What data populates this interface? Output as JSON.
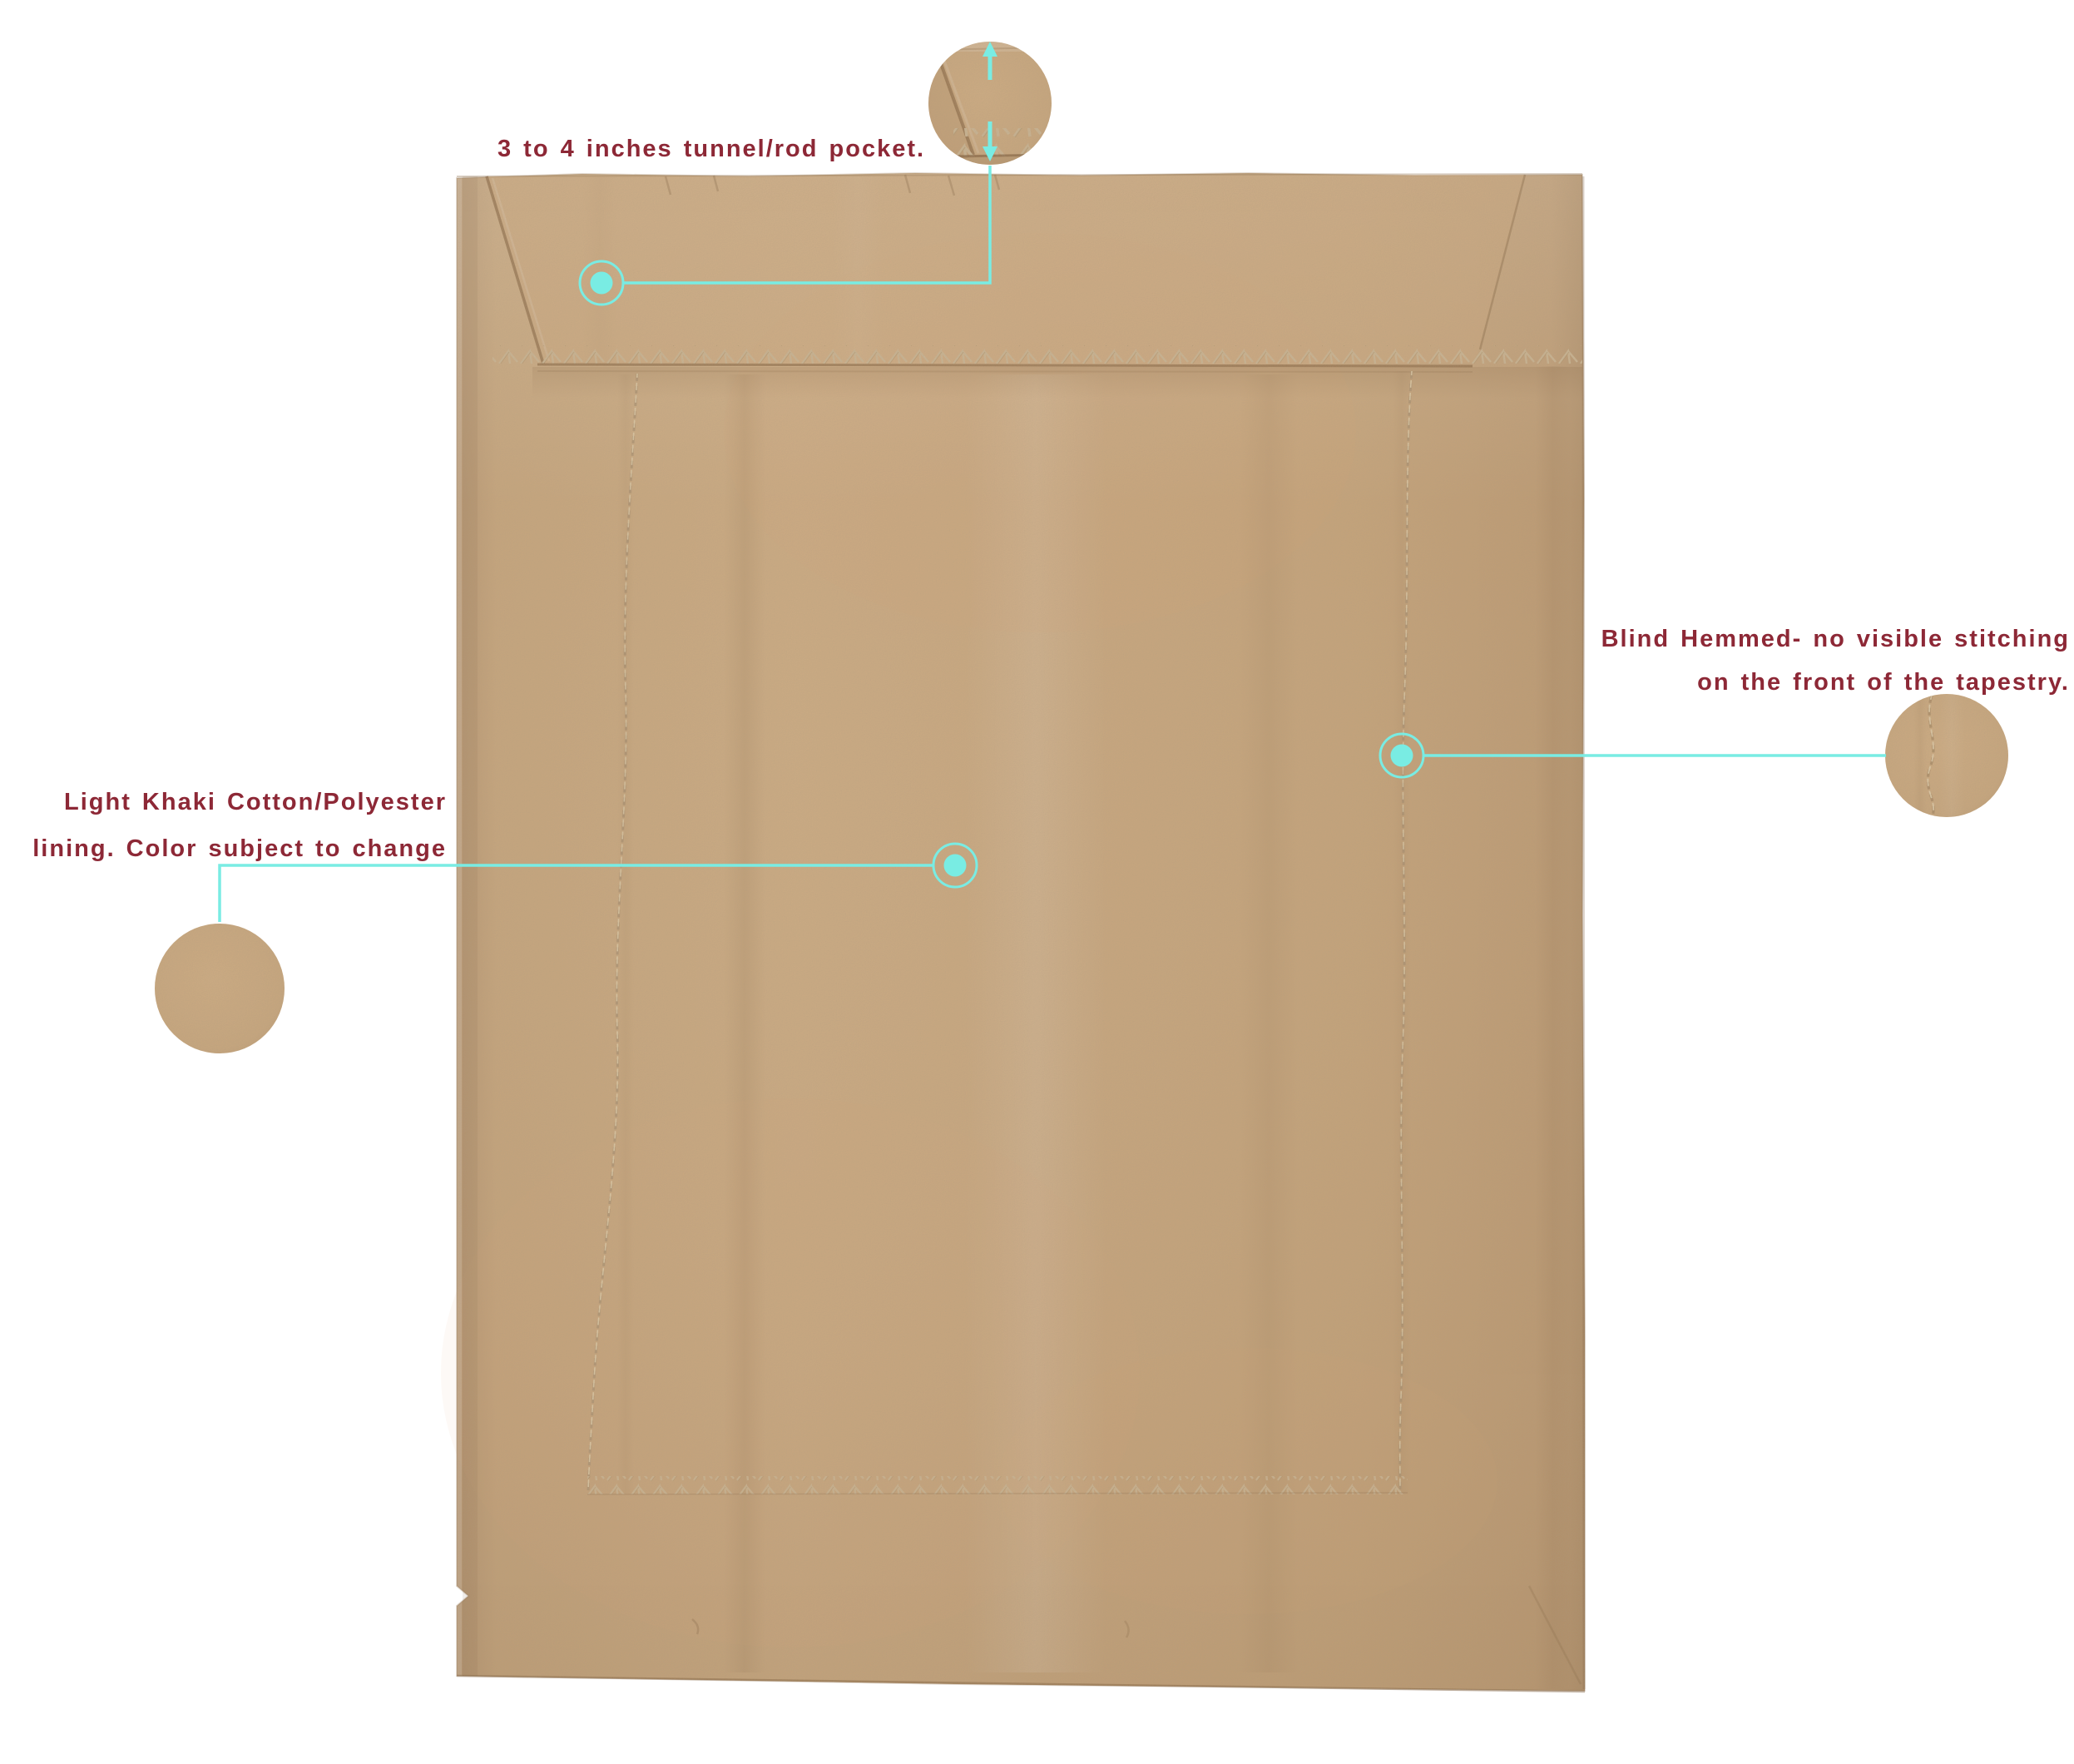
{
  "diagram": {
    "background_color": "#ffffff",
    "fabric_color": "#cba87e",
    "accent_color": "#79ece3",
    "label_color": "#8d2836",
    "subject": "tapestry back panel"
  },
  "annotations": {
    "rod_pocket": {
      "text": "3 to 4 inches tunnel/rod pocket."
    },
    "lining": {
      "line1": "Light Khaki Cotton/Polyester",
      "line2": "lining. Color subject to change"
    },
    "blind_hem": {
      "line1": "Blind Hemmed- no visible stitching",
      "line2": "on the front of the tapestry."
    }
  },
  "icons": {
    "up_arrow": "arrow-up-icon",
    "down_arrow": "arrow-down-icon",
    "callout_dot": "callout-dot-icon"
  }
}
